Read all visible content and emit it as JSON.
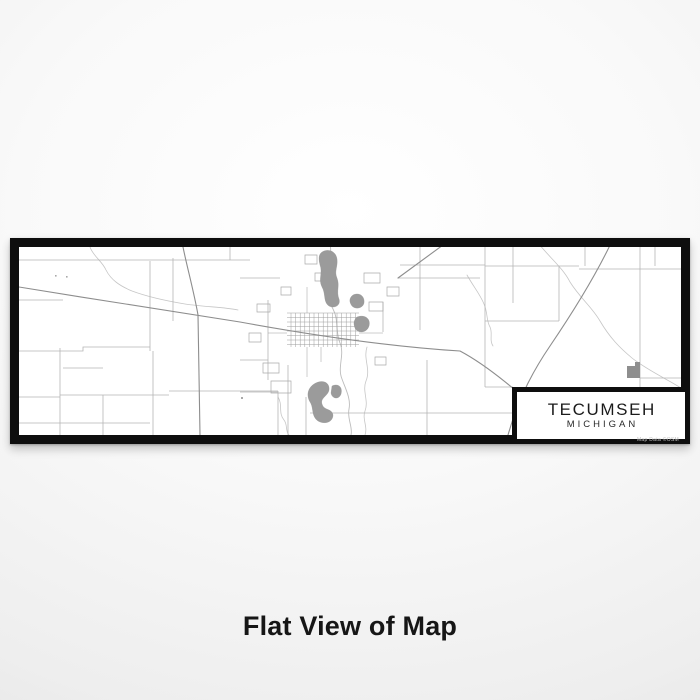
{
  "product": {
    "caption": "Flat View of Map"
  },
  "map_print": {
    "city": "TECUMSEH",
    "state": "MICHIGAN",
    "attribution": "Map Data ©OSM",
    "colors": {
      "frame": "#0e0e0e",
      "paper": "#ffffff",
      "backdrop": "#ececec",
      "road_minor": "#b5b5b5",
      "road_major": "#8d8d8d",
      "stream": "#c6c6c6",
      "water": "#9b9b9b",
      "caption_text": "#161616"
    }
  }
}
